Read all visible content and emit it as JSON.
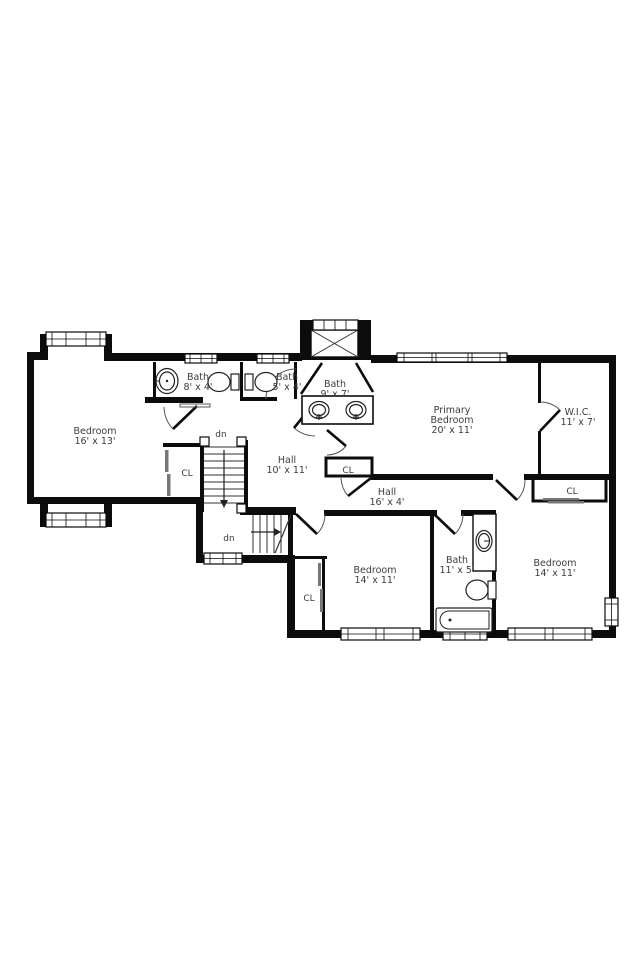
{
  "plan": {
    "background": "#ffffff",
    "wall_color": "#0c0c0c",
    "label_color": "#3d3d3d",
    "labels": {
      "bedroom_tl": {
        "name": "Bedroom",
        "dims": "16' x 13'"
      },
      "bath_8x4": {
        "name": "Bath",
        "dims": "8' x 4'"
      },
      "bath_5x4": {
        "name": "Bath",
        "dims": "5' x 4'"
      },
      "bath_9x7": {
        "name": "Bath",
        "dims": "9' x 7'"
      },
      "primary": {
        "line1": "Primary",
        "line2": "Bedroom",
        "dims": "20' x 11'"
      },
      "wic": {
        "name": "W.I.C.",
        "dims": "11' x 7'"
      },
      "hall_upper": {
        "name": "Hall",
        "dims": "10' x 11'"
      },
      "hall_lower": {
        "name": "Hall",
        "dims": "16' x 4'"
      },
      "bedroom_mid": {
        "name": "Bedroom",
        "dims": "14' x 11'"
      },
      "bedroom_right": {
        "name": "Bedroom",
        "dims": "14' x 11'"
      },
      "bath_11x5": {
        "name": "Bath",
        "dims": "11' x 5'"
      },
      "closet_left": {
        "label": "CL"
      },
      "closet_hall": {
        "label": "CL"
      },
      "closet_right": {
        "label": "CL"
      },
      "closet_bottom": {
        "label": "CL"
      },
      "stairs_upper": {
        "label": "dn"
      },
      "stairs_lower": {
        "label": "dn"
      }
    }
  }
}
